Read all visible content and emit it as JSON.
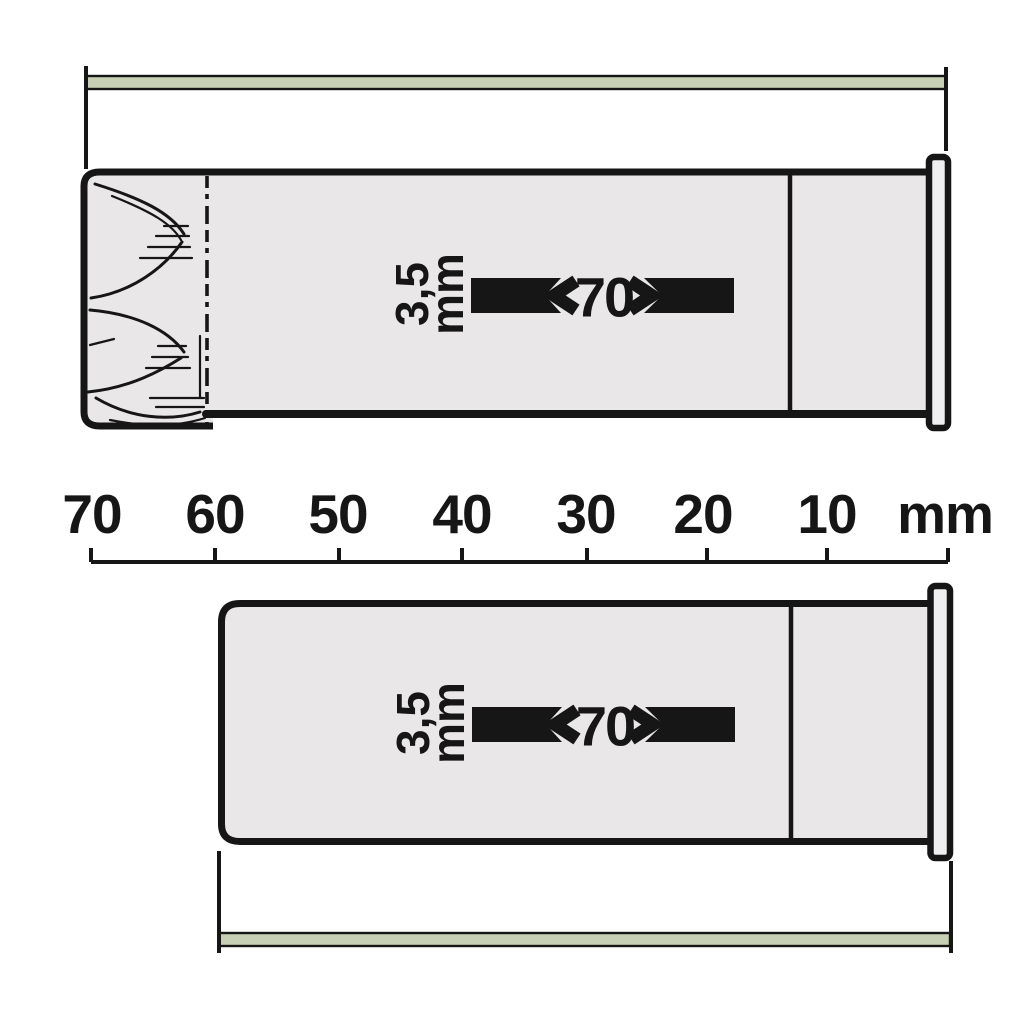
{
  "colors": {
    "page_bg": "#ffffff",
    "ink": "#161616",
    "body_fill": "#e9e7e8",
    "rim_fill": "#efeef0",
    "green_bar": "#c7cfb4"
  },
  "ruler": {
    "tick_labels": [
      "70",
      "60",
      "50",
      "40",
      "30",
      "20",
      "10"
    ],
    "unit_label": "mm"
  },
  "fired_shell": {
    "bore_label_line1": "3,5",
    "bore_label_line2": "mm",
    "length_label": "70"
  },
  "crimped_shell": {
    "bore_label_line1": "3,5",
    "bore_label_line2": "mm",
    "length_label": "70"
  }
}
